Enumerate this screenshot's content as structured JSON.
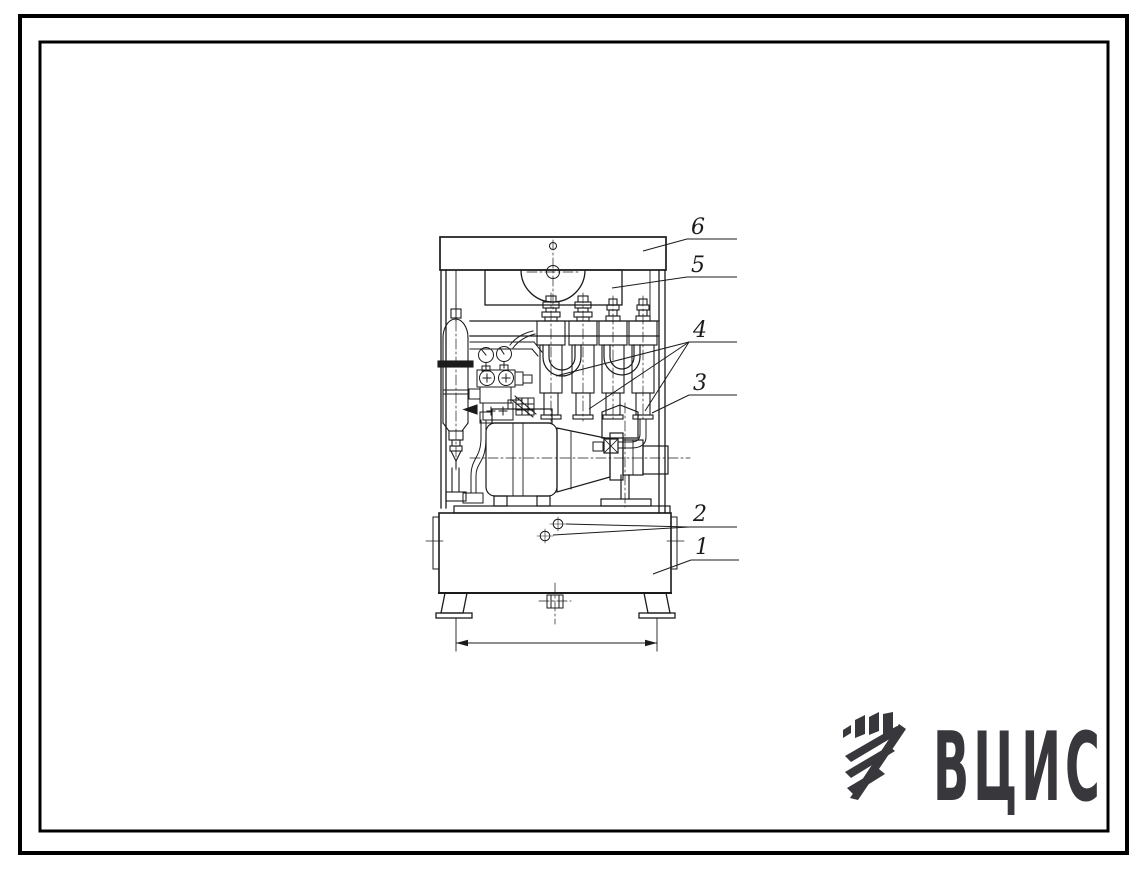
{
  "page": {
    "background": "#ffffff",
    "frame_color": "#000000"
  },
  "drawing": {
    "subject": "pump-station-front-view",
    "line_color": "#1b1b1b",
    "callouts": [
      {
        "label": "6"
      },
      {
        "label": "5"
      },
      {
        "label": "4"
      },
      {
        "label": "3"
      },
      {
        "label": "2"
      },
      {
        "label": "1"
      }
    ]
  },
  "logo": {
    "text": "ВЦИС",
    "color": "#37373c"
  }
}
